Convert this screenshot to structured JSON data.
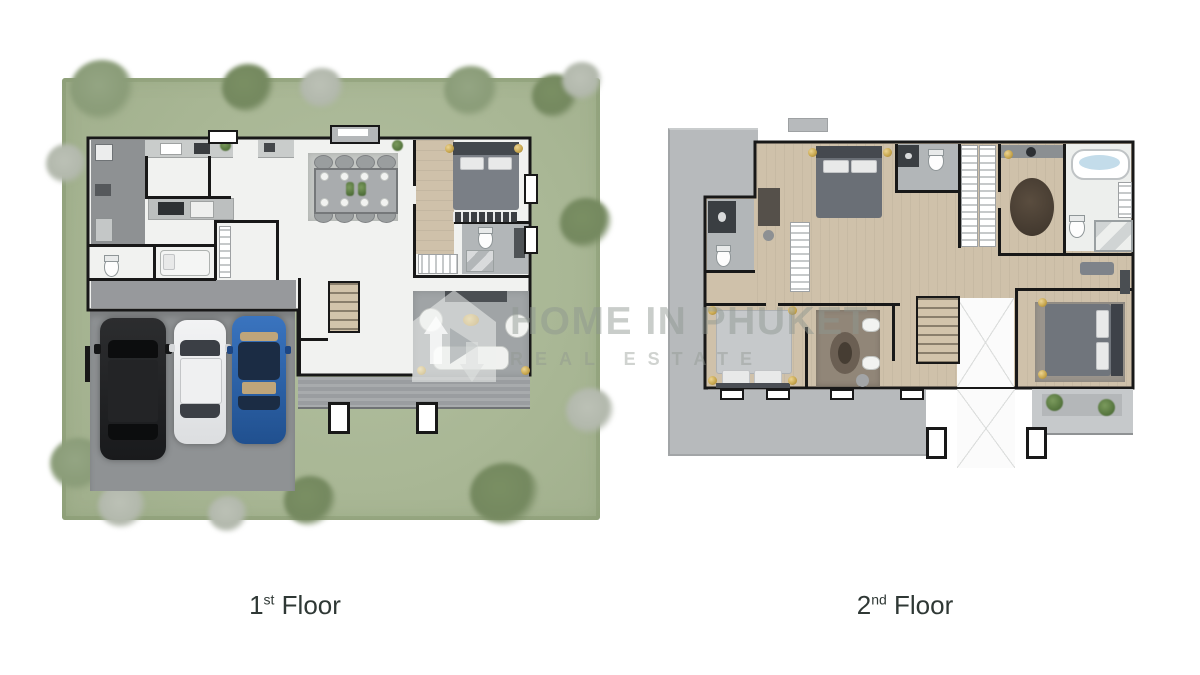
{
  "watermark": {
    "logo_icon": "home-in-phuket-logo-icon",
    "title": "HOME IN PHUKET",
    "subtitle": "REAL ESTATE"
  },
  "labels": {
    "first_floor": {
      "number": "1",
      "ordinal": "st",
      "word": "Floor"
    },
    "second_floor": {
      "number": "2",
      "ordinal": "nd",
      "word": "Floor"
    }
  },
  "plans": {
    "first_floor": {
      "name": "1st Floor plan",
      "features": [
        "lawn with trees",
        "driveway",
        "black SUV",
        "white car",
        "blue car",
        "kitchen counters",
        "dining table with 8 chairs",
        "bedroom with bed",
        "bathrooms",
        "maid room",
        "stairs",
        "living room sofa set",
        "terrace"
      ]
    },
    "second_floor": {
      "name": "2nd Floor plan",
      "features": [
        "roof terrace",
        "bedroom with dark bed",
        "shared bathroom",
        "walk-in closet with oval rug",
        "master bathroom with bathtub",
        "vanity desk",
        "bedroom with light bed",
        "sitting room rug",
        "stairs",
        "double-height void",
        "master bedroom",
        "balcony with plants"
      ]
    }
  },
  "colors": {
    "lawn_green": "#a9b795",
    "tree_green": "#74885f",
    "driveway_gray": "#909396",
    "wall_black": "#181818",
    "floor_white": "#f1f2f0",
    "wood_floor": "#cfc1aa",
    "roof_gray": "#b7babc",
    "tile_gray": "#b2b6b8",
    "bed_gray": "#787d84",
    "gold_accent": "#c9a850",
    "car_black": "#1f2123",
    "car_white": "#e9eaeb",
    "car_blue": "#2b63ad",
    "bathtub_blue": "#c3dcea",
    "label_text": "#2f3835",
    "watermark_gray": "#8f9690"
  }
}
